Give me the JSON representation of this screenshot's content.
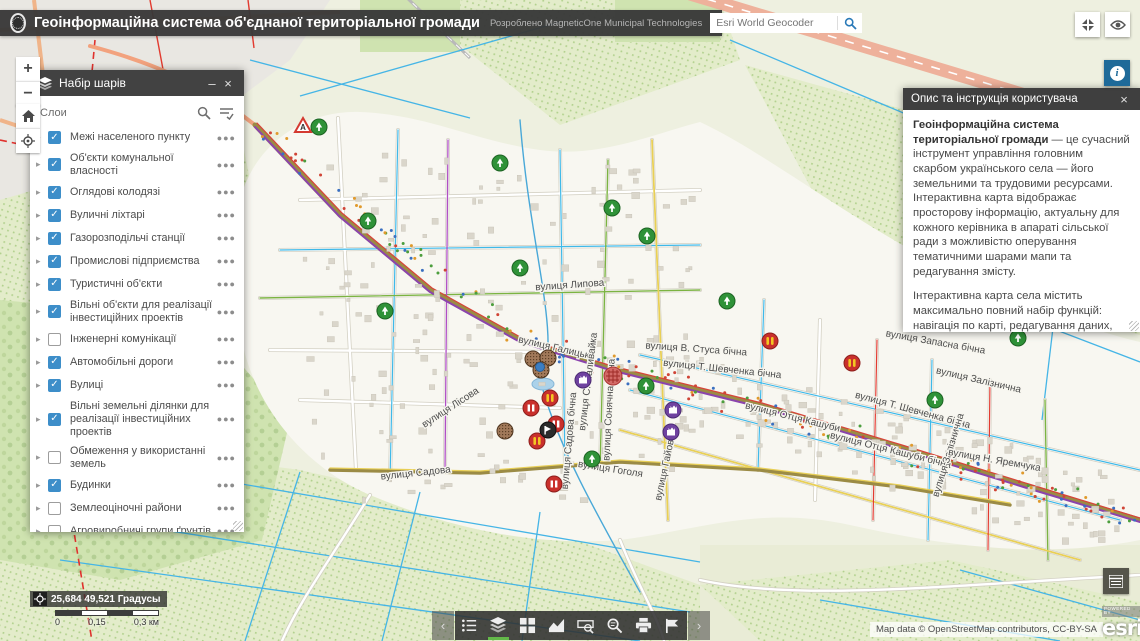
{
  "header": {
    "title": "Геоінформаційна система об'єднаної територіальної громади",
    "subtitle": "Розроблено MagneticOne Municipal Technologies",
    "search_placeholder": "Esri World Geocoder"
  },
  "layers_panel": {
    "title": "Набір шарів",
    "minimize": "–",
    "close": "×",
    "subtitle": "Слои",
    "items": [
      {
        "label": "Межі населеного пункту",
        "checked": true
      },
      {
        "label": "Об'єкти комунальної власності",
        "checked": true
      },
      {
        "label": "Оглядові колодязі",
        "checked": true
      },
      {
        "label": "Вуличні ліхтарі",
        "checked": true
      },
      {
        "label": "Газорозподільчі станції",
        "checked": true
      },
      {
        "label": "Промислові підприємства",
        "checked": true
      },
      {
        "label": "Туристичні об'єкти",
        "checked": true
      },
      {
        "label": "Вільні об'єкти для реалізації інвестиційних проектів",
        "checked": true
      },
      {
        "label": "Інженерні комунікації",
        "checked": false
      },
      {
        "label": "Автомобільні дороги",
        "checked": true
      },
      {
        "label": "Вулиці",
        "checked": true
      },
      {
        "label": "Вільні земельні ділянки для реалізації інвестиційних проектів",
        "checked": true
      },
      {
        "label": "Обмеження у використанні земель",
        "checked": false
      },
      {
        "label": "Будинки",
        "checked": true
      },
      {
        "label": "Землеоціночні райони",
        "checked": false
      },
      {
        "label": "Агровиробничі групи ґрунтів",
        "checked": false
      },
      {
        "label": "Кадастровий поділ",
        "checked": false
      }
    ]
  },
  "right_panel": {
    "title": "Опис та інструкція користувача",
    "close": "×",
    "lead_bold": "Геоінформаційна система територіальної громади",
    "lead_rest": " — це сучасний інструмент управління головним скарбом українського села — його земельними та трудовими ресурсами.",
    "lead_line2": "Інтерактивна карта відображає просторову інформацію, актуальну для кожного керівника в апараті сільської ради з можливістю оперування тематичними шарами мапи та редагування змісту.",
    "para2": "Інтерактивна карта села містить максимально повний набір функцій: навігація по карті, редагування даних, оперування векторними шарами карти, просторовий аналіз, адресний пошук тощо.",
    "tools_heading": "Панель інструментів ГІС",
    "tool_overview_label": "- відкрити/приховати оглядову карту;"
  },
  "map_controls": {
    "zoom_in": "+",
    "zoom_out": "−"
  },
  "statusbar": {
    "coordinates": "25,684 49,521 Градусы",
    "scale_ticks": [
      "0",
      "0,15",
      "0,3 км"
    ]
  },
  "attribution": {
    "text": "Map data © OpenStreetMap contributors, CC-BY-SA",
    "powered_by": "POWERED BY",
    "esri": "esri"
  },
  "toolbar": {
    "tools": [
      "legend",
      "layers",
      "basemap-gallery",
      "chart",
      "measurement",
      "query",
      "print",
      "draw"
    ],
    "active": "layers"
  },
  "map": {
    "street_labels": [
      {
        "text": "вулиця Лукашівська",
        "x": 166,
        "y": 183,
        "r": 58
      },
      {
        "text": "вулиця Липова",
        "x": 570,
        "y": 288,
        "r": -4
      },
      {
        "text": "вулиця Галицька",
        "x": 556,
        "y": 351,
        "r": 13
      },
      {
        "text": "вулиця С. Наливайка",
        "x": 591,
        "y": 382,
        "r": -83
      },
      {
        "text": "вулиця Сонячна бічна",
        "x": 612,
        "y": 410,
        "r": -87
      },
      {
        "text": "вулиця В. Стуса бічна",
        "x": 696,
        "y": 352,
        "r": 4
      },
      {
        "text": "вулиця Т. Шевченка бічна",
        "x": 722,
        "y": 372,
        "r": 6
      },
      {
        "text": "вулиця Запасна бічна",
        "x": 935,
        "y": 345,
        "r": 10
      },
      {
        "text": "вулиця Залізнична",
        "x": 978,
        "y": 383,
        "r": 13
      },
      {
        "text": "вулиця Т. Шевченка бічна",
        "x": 912,
        "y": 413,
        "r": 15
      },
      {
        "text": "вулиця Отця Кашуби",
        "x": 792,
        "y": 420,
        "r": 14
      },
      {
        "text": "вулиця Отця Кашуби бічна",
        "x": 890,
        "y": 453,
        "r": 14
      },
      {
        "text": "вулиця Залізнична",
        "x": 951,
        "y": 456,
        "r": -73
      },
      {
        "text": "вулиця Н. Яремчука",
        "x": 994,
        "y": 463,
        "r": 10
      },
      {
        "text": "вулиця Лісова",
        "x": 452,
        "y": 410,
        "r": -33
      },
      {
        "text": "вулиця Садова",
        "x": 416,
        "y": 476,
        "r": -6
      },
      {
        "text": "вулиця Садова бічна",
        "x": 572,
        "y": 441,
        "r": -85
      },
      {
        "text": "вулиця Гоголя",
        "x": 610,
        "y": 472,
        "r": 9
      },
      {
        "text": "вулиця Гайова",
        "x": 668,
        "y": 468,
        "r": -78
      }
    ],
    "markers": [
      {
        "t": "warn",
        "x": 303,
        "y": 126
      },
      {
        "t": "green",
        "x": 319,
        "y": 127
      },
      {
        "t": "green",
        "x": 368,
        "y": 221
      },
      {
        "t": "green",
        "x": 385,
        "y": 311
      },
      {
        "t": "green",
        "x": 500,
        "y": 163
      },
      {
        "t": "green",
        "x": 612,
        "y": 208
      },
      {
        "t": "green",
        "x": 520,
        "y": 268
      },
      {
        "t": "green",
        "x": 647,
        "y": 236
      },
      {
        "t": "green",
        "x": 727,
        "y": 301
      },
      {
        "t": "green",
        "x": 646,
        "y": 386
      },
      {
        "t": "green",
        "x": 592,
        "y": 459
      },
      {
        "t": "green",
        "x": 935,
        "y": 400
      },
      {
        "t": "green",
        "x": 1018,
        "y": 338
      },
      {
        "t": "redlamp",
        "x": 770,
        "y": 341
      },
      {
        "t": "redlamp",
        "x": 852,
        "y": 363
      },
      {
        "t": "red",
        "x": 531,
        "y": 408
      },
      {
        "t": "redlamp",
        "x": 550,
        "y": 398
      },
      {
        "t": "red",
        "x": 556,
        "y": 424
      },
      {
        "t": "redlamp",
        "x": 537,
        "y": 441
      },
      {
        "t": "red",
        "x": 554,
        "y": 484
      },
      {
        "t": "redhatch",
        "x": 613,
        "y": 376
      },
      {
        "t": "dark",
        "x": 548,
        "y": 430
      },
      {
        "t": "purple",
        "x": 583,
        "y": 380
      },
      {
        "t": "purple",
        "x": 673,
        "y": 410
      },
      {
        "t": "purple",
        "x": 671,
        "y": 432
      },
      {
        "t": "brown",
        "x": 533,
        "y": 359
      },
      {
        "t": "brown",
        "x": 548,
        "y": 358
      },
      {
        "t": "brown",
        "x": 541,
        "y": 370
      },
      {
        "t": "brown",
        "x": 505,
        "y": 431
      },
      {
        "t": "bluedot",
        "x": 540,
        "y": 367
      }
    ]
  }
}
